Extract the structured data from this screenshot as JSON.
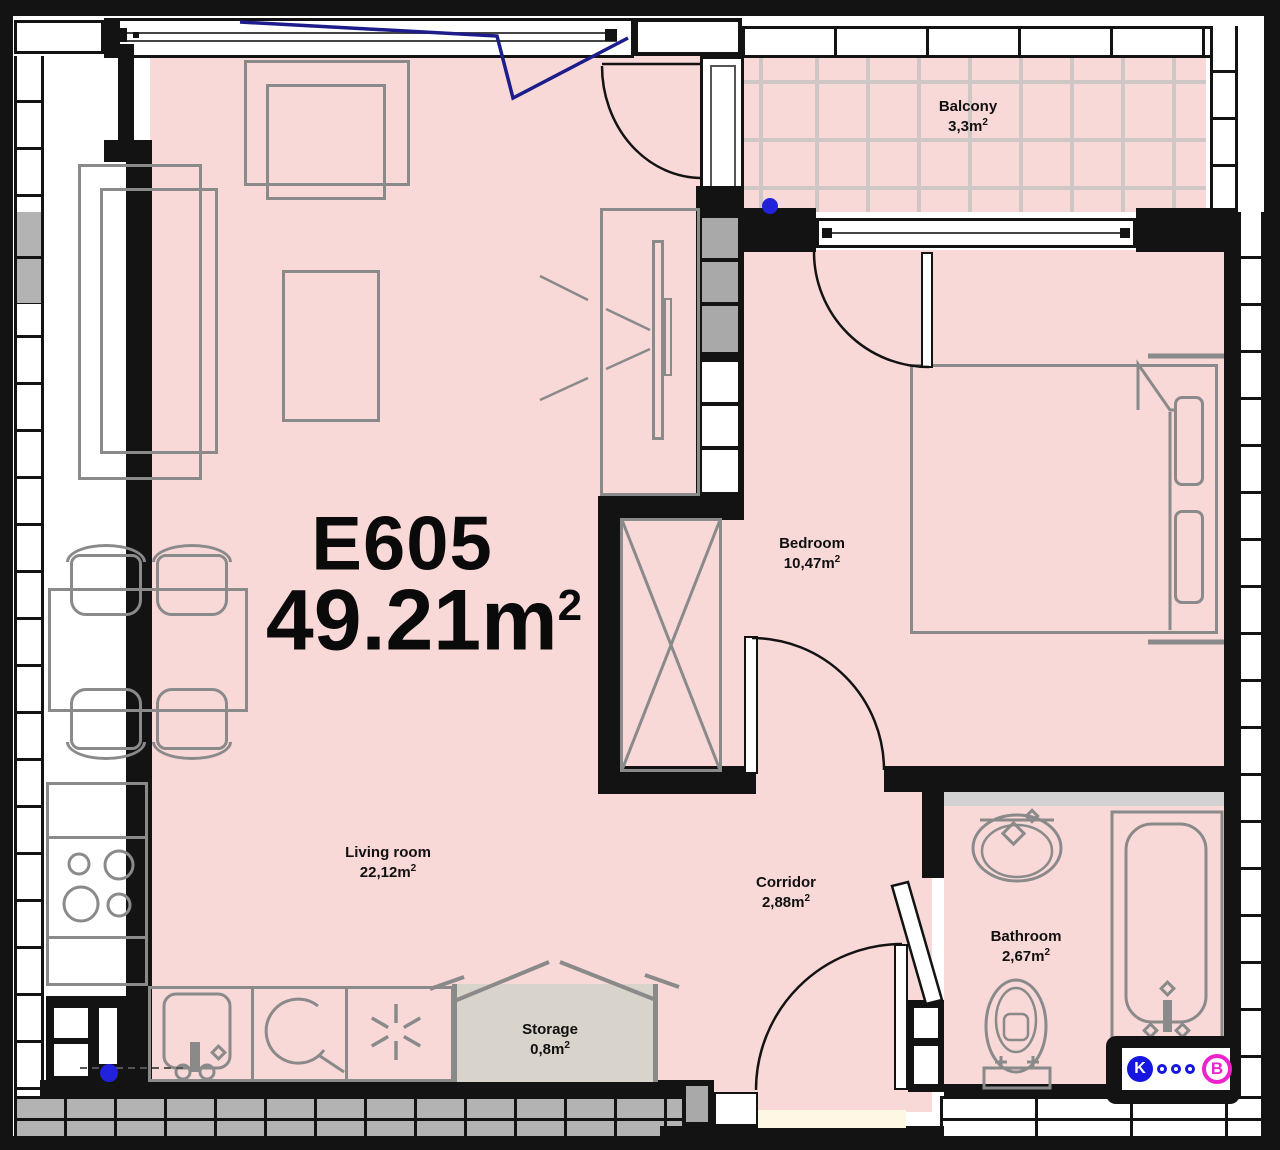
{
  "plan": {
    "unit": {
      "id": "E605",
      "area": "49.21m",
      "area_sup": "2"
    },
    "rooms": [
      {
        "key": "balcony",
        "name": "Balcony",
        "area": "3,3m",
        "sup": "2"
      },
      {
        "key": "bedroom",
        "name": "Bedroom",
        "area": "10,47m",
        "sup": "2"
      },
      {
        "key": "living",
        "name": "Living room",
        "area": "22,12m",
        "sup": "2"
      },
      {
        "key": "corridor",
        "name": "Corridor",
        "area": "2,88m",
        "sup": "2"
      },
      {
        "key": "bathroom",
        "name": "Bathroom",
        "area": "2,67m",
        "sup": "2"
      },
      {
        "key": "storage",
        "name": "Storage",
        "area": "0,8m",
        "sup": "2"
      }
    ],
    "logo": {
      "letter_k": "K",
      "letter_b": "B"
    },
    "colors": {
      "floor": "#f9d8d8",
      "wall": "#131313",
      "furniture": "#8a8a8a",
      "storage_fill": "#d8d3cb",
      "navy": "#1c1c8a",
      "marker_blue": "#2222dd",
      "logo_blue": "#1616e0",
      "logo_magenta": "#ee22cc",
      "brick_gray": "#b3b3b3",
      "threshold": "#fcf8e4",
      "tile_grout": "#cfc6c6"
    }
  }
}
